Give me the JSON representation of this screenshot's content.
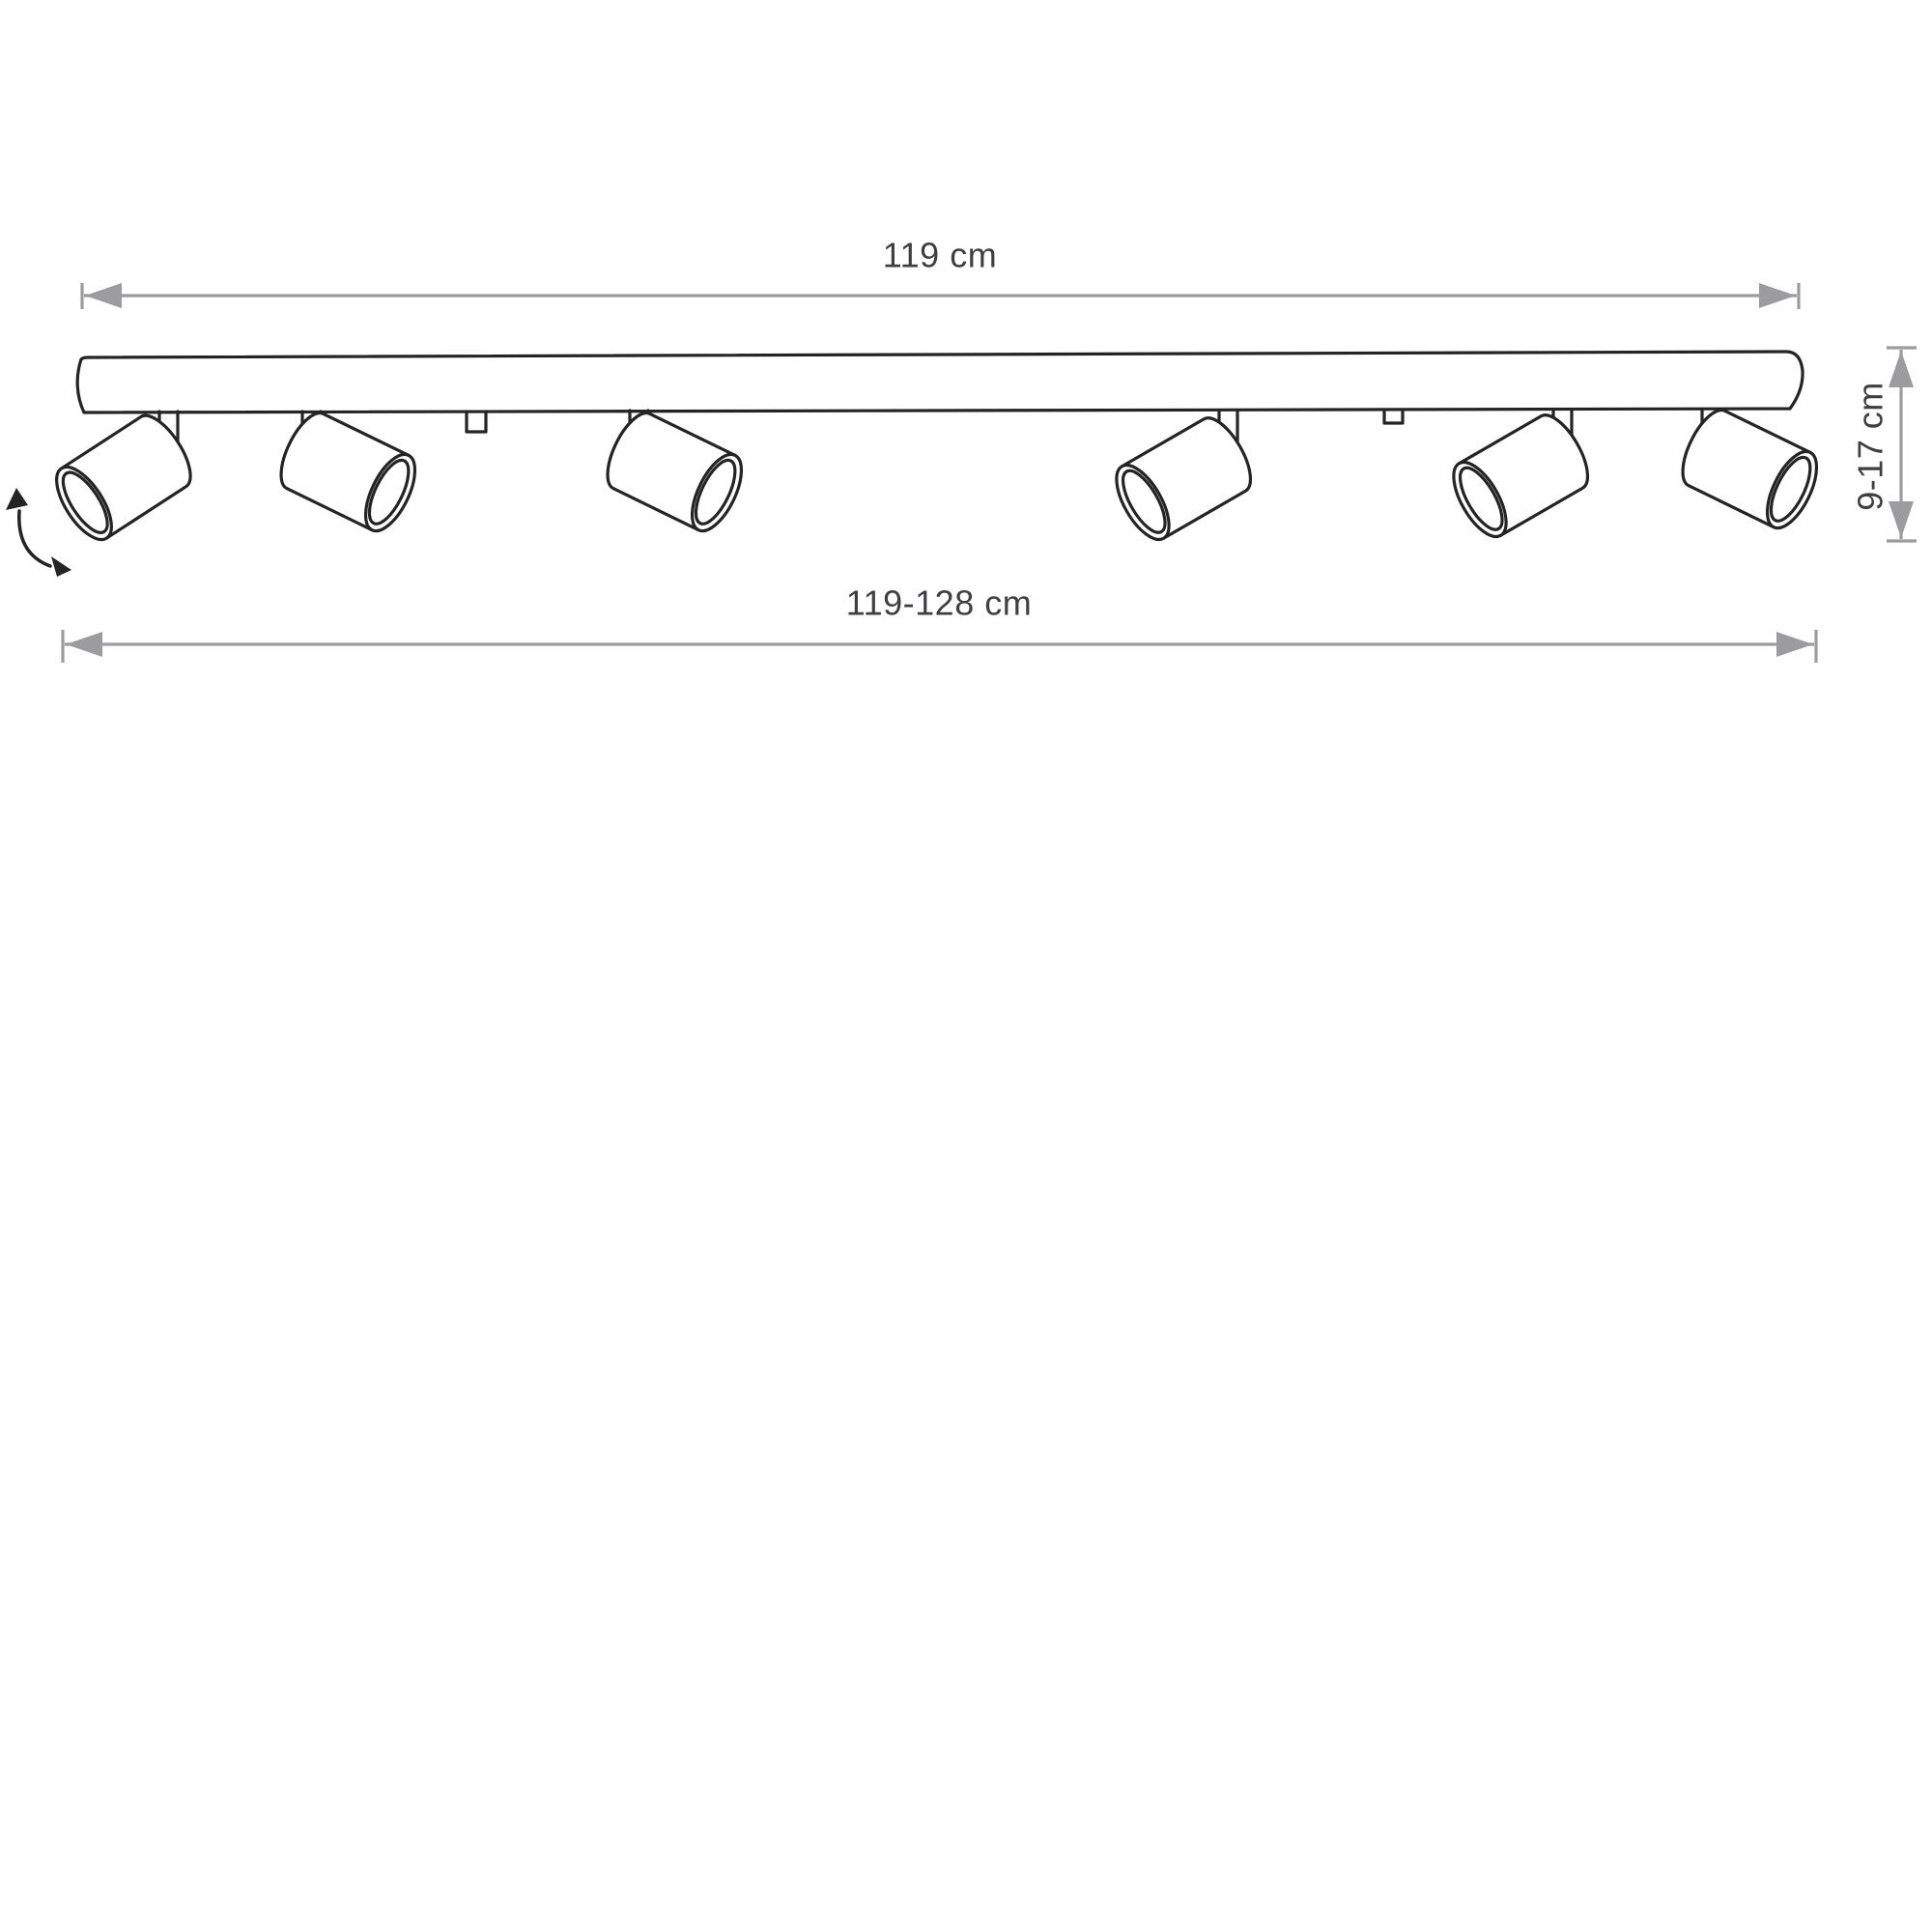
{
  "diagram": {
    "kind": "technical dimension drawing of a 6-spot ceiling track light",
    "dimensions": {
      "bar_length_label": "119 cm",
      "adjustable_length_label": "119-128 cm",
      "height_label": "9-17 cm"
    },
    "spotlight_count": 6,
    "mounting_tab_count": 2,
    "icons": {
      "rotation_arrow": "curved double-headed arrow indicating adjustable spotlight tilt",
      "dimension_arrows": "double-headed measurement arrows with end ticks"
    },
    "colors": {
      "outline": "#242424",
      "dimension_line": "#9c9c9e",
      "label_text": "#3f3f41",
      "background": "#ffffff"
    }
  }
}
